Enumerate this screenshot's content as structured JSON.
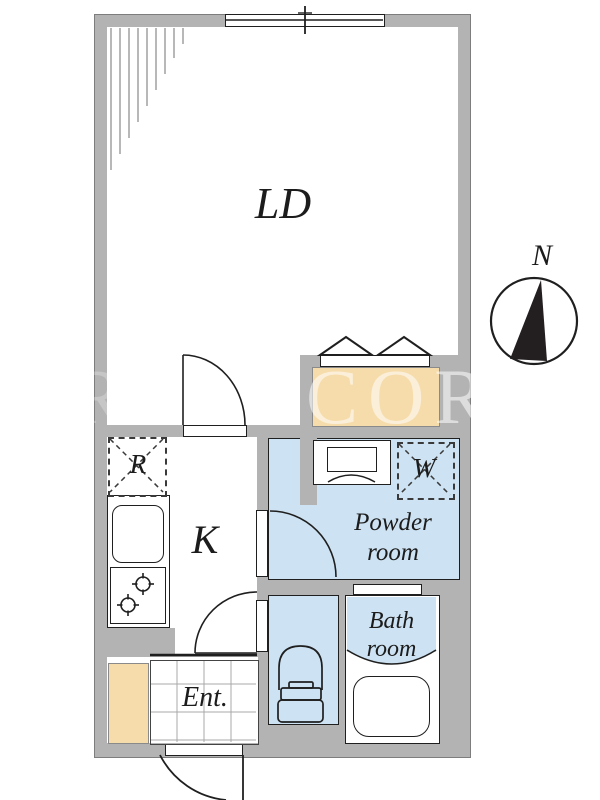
{
  "labels": {
    "ld": "LD",
    "k": "K",
    "r": "R",
    "w": "W",
    "powder": [
      "Powder",
      "room"
    ],
    "bath": [
      "Bath",
      "room"
    ],
    "ent": "Ent.",
    "north": "N"
  },
  "watermark": {
    "main": "COR",
    "partial": "R"
  },
  "colors": {
    "wall": "#b3b3b3",
    "wet_area": "#cde2f2",
    "wood_area": "#f6dcab",
    "line": "#1f1f1f"
  }
}
